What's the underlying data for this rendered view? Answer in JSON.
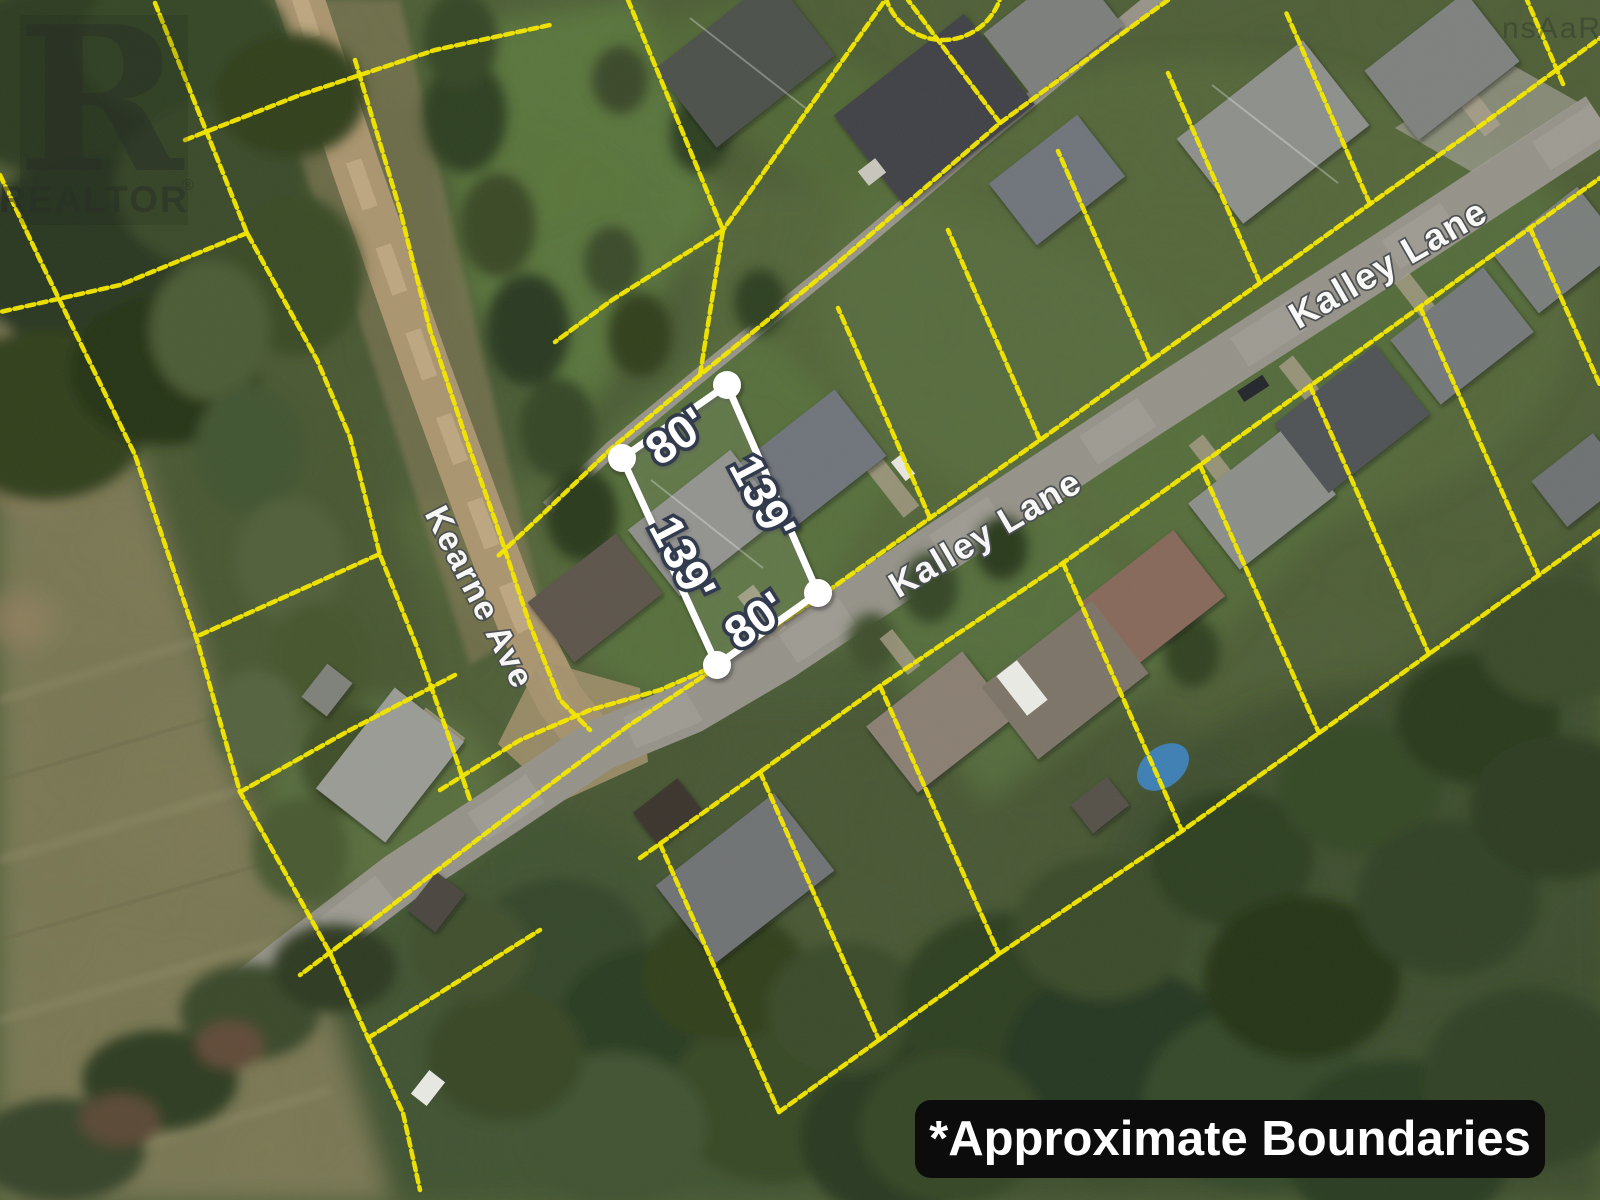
{
  "streets": {
    "kearne": "Kearne Ave",
    "kalley_mid": "Kalley Lane",
    "kalley_upper": "Kalley Lane"
  },
  "lot": {
    "dimensions": {
      "top": "80'",
      "right": "139'",
      "left": "139'",
      "bottom": "80'"
    }
  },
  "banner": {
    "text": "*Approximate Boundaries"
  },
  "watermarks": {
    "realtor_r": "R",
    "realtor_name": "REALTOR",
    "registered": "®",
    "corner": "nsAaR"
  },
  "colors": {
    "boundary_yellow": "#f3e600",
    "highlight_white": "#ffffff",
    "label_outline": "#333b4e",
    "banner_bg": "#0c0c0c",
    "banner_text": "#ffffff",
    "pool_blue": "#3e7fb3"
  }
}
